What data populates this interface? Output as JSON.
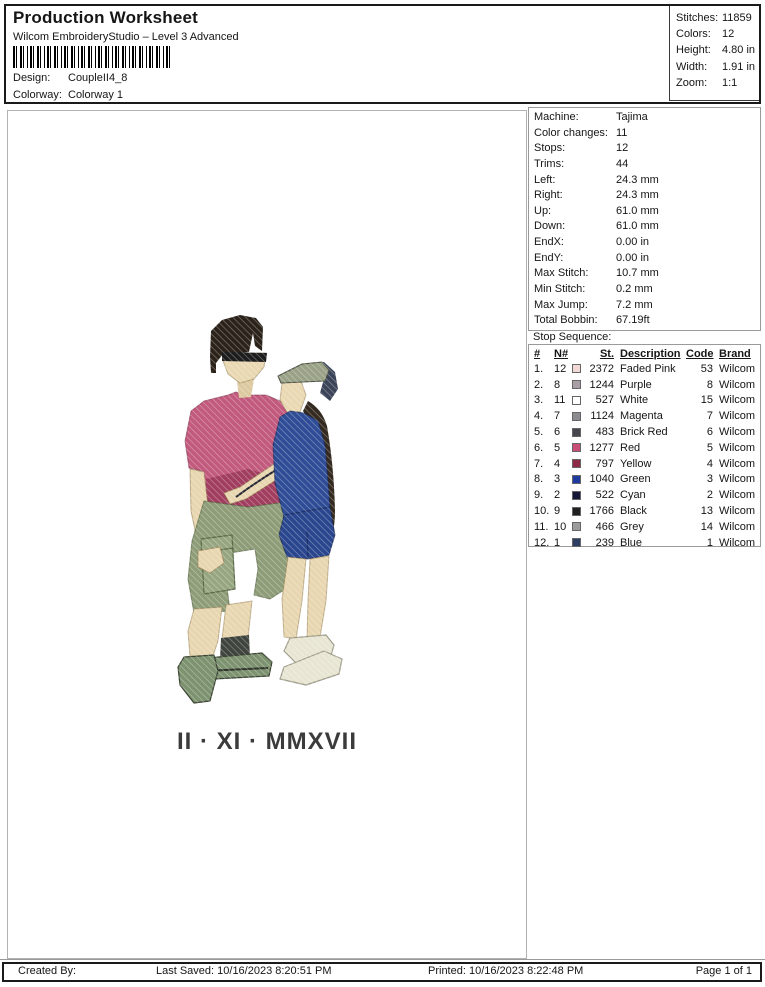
{
  "header": {
    "title": "Production Worksheet",
    "subtitle": "Wilcom EmbroideryStudio – Level 3 Advanced",
    "design_label": "Design:",
    "design_value": "CoupleII4_8",
    "colorway_label": "Colorway:",
    "colorway_value": "Colorway 1",
    "stats": [
      {
        "label": "Stitches:",
        "value": "11859"
      },
      {
        "label": "Colors:",
        "value": "12"
      },
      {
        "label": "Height:",
        "value": "4.80 in"
      },
      {
        "label": "Width:",
        "value": "1.91 in"
      },
      {
        "label": "Zoom:",
        "value": "1:1"
      }
    ]
  },
  "machine_info": {
    "rows": [
      {
        "label": "Machine:",
        "value": "Tajima"
      },
      {
        "label": "Color changes:",
        "value": "11"
      },
      {
        "label": "Stops:",
        "value": "12"
      },
      {
        "label": "Trims:",
        "value": "44"
      },
      {
        "label": "Left:",
        "value": "24.3 mm"
      },
      {
        "label": "Right:",
        "value": "24.3 mm"
      },
      {
        "label": "Up:",
        "value": "61.0 mm"
      },
      {
        "label": "Down:",
        "value": "61.0 mm"
      },
      {
        "label": "EndX:",
        "value": "0.00 in"
      },
      {
        "label": "EndY:",
        "value": "0.00 in"
      },
      {
        "label": "Max Stitch:",
        "value": "10.7 mm"
      },
      {
        "label": "Min Stitch:",
        "value": "0.2 mm"
      },
      {
        "label": "Max Jump:",
        "value": "7.2 mm"
      },
      {
        "label": "Total Bobbin:",
        "value": "67.19ft"
      }
    ]
  },
  "stop_sequence": {
    "title": "Stop Sequence:",
    "columns": {
      "num": "#",
      "n": "N#",
      "st": "St.",
      "description": "Description",
      "code": "Code",
      "brand": "Brand"
    },
    "rows": [
      {
        "num": "1.",
        "n": "12",
        "swatch": "#f2d9d6",
        "st": "2372",
        "description": "Faded Pink",
        "code": "53",
        "brand": "Wilcom"
      },
      {
        "num": "2.",
        "n": "8",
        "swatch": "#aa9ea6",
        "st": "1244",
        "description": "Purple",
        "code": "8",
        "brand": "Wilcom"
      },
      {
        "num": "3.",
        "n": "11",
        "swatch": "#ffffff",
        "st": "527",
        "description": "White",
        "code": "15",
        "brand": "Wilcom"
      },
      {
        "num": "4.",
        "n": "7",
        "swatch": "#8b8b90",
        "st": "1124",
        "description": "Magenta",
        "code": "7",
        "brand": "Wilcom"
      },
      {
        "num": "5.",
        "n": "6",
        "swatch": "#46464c",
        "st": "483",
        "description": "Brick Red",
        "code": "6",
        "brand": "Wilcom"
      },
      {
        "num": "6.",
        "n": "5",
        "swatch": "#c94d79",
        "st": "1277",
        "description": "Red",
        "code": "5",
        "brand": "Wilcom"
      },
      {
        "num": "7.",
        "n": "4",
        "swatch": "#8d2a48",
        "st": "797",
        "description": "Yellow",
        "code": "4",
        "brand": "Wilcom"
      },
      {
        "num": "8.",
        "n": "3",
        "swatch": "#1f3a9e",
        "st": "1040",
        "description": "Green",
        "code": "3",
        "brand": "Wilcom"
      },
      {
        "num": "9.",
        "n": "2",
        "swatch": "#17173a",
        "st": "522",
        "description": "Cyan",
        "code": "2",
        "brand": "Wilcom"
      },
      {
        "num": "10.",
        "n": "9",
        "swatch": "#202020",
        "st": "1766",
        "description": "Black",
        "code": "13",
        "brand": "Wilcom"
      },
      {
        "num": "11.",
        "n": "10",
        "swatch": "#9c9c9c",
        "st": "466",
        "description": "Grey",
        "code": "14",
        "brand": "Wilcom"
      },
      {
        "num": "12.",
        "n": "1",
        "swatch": "#2e3e63",
        "st": "239",
        "description": "Blue",
        "code": "1",
        "brand": "Wilcom"
      }
    ]
  },
  "design": {
    "date_text": "II · XI · MMXVII"
  },
  "footer": {
    "created_by": "Created By:",
    "last_saved": "Last Saved: 10/16/2023 8:20:51 PM",
    "printed": "Printed: 10/16/2023 8:22:48 PM",
    "page": "Page 1 of 1"
  }
}
